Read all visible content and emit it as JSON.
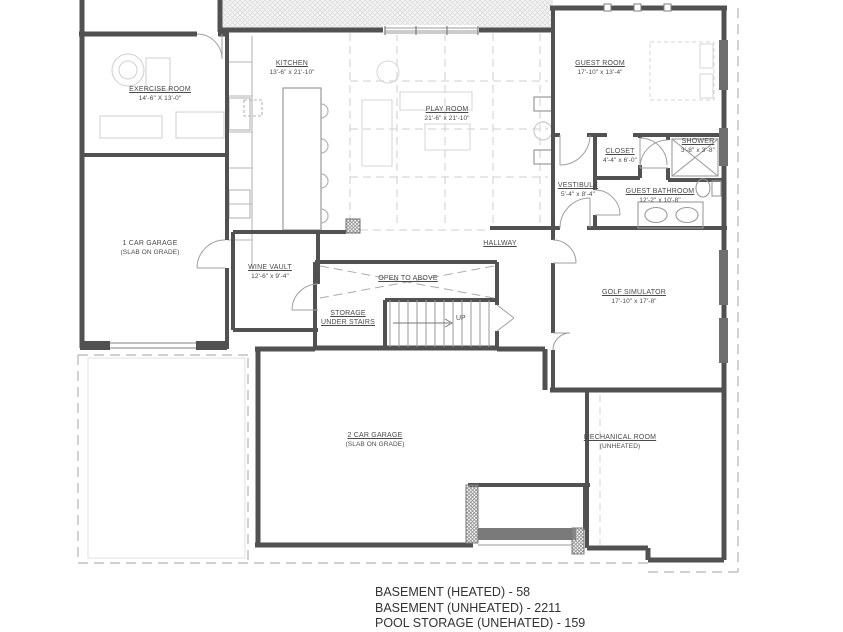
{
  "plan_title": "Basement Floor Plan",
  "rooms": [
    {
      "name": "EXERCISE ROOM",
      "dims": "14'-6\" X 13'-0\""
    },
    {
      "name": "KITCHEN",
      "dims": "13'-6\" x 21'-10\""
    },
    {
      "name": "PLAY ROOM",
      "dims": "21'-6\" x 21'-10\""
    },
    {
      "name": "GUEST ROOM",
      "dims": "17'-10\" x 13'-4\""
    },
    {
      "name": "CLOSET",
      "dims": "4'-4\" x 6'-0\""
    },
    {
      "name": "SHOWER",
      "dims": "3'-8\" x 3'-8\""
    },
    {
      "name": "VESTIBULE",
      "dims": "5'-4\" x 8'-4\""
    },
    {
      "name": "GUEST BATHROOM",
      "dims": "12'-2\" x 10'-8\""
    },
    {
      "name": "HALLWAY",
      "dims": ""
    },
    {
      "name": "1 CAR GARAGE",
      "dims": "(SLAB ON GRADE)"
    },
    {
      "name": "WINE VAULT",
      "dims": "12'-6\" x 9'-4\""
    },
    {
      "name": "OPEN TO ABOVE",
      "dims": ""
    },
    {
      "name": "STORAGE UNDER STAIRS",
      "dims": ""
    },
    {
      "name": "GOLF SIMULATOR",
      "dims": "17'-10\" x 17'-8\""
    },
    {
      "name": "2 CAR GARAGE",
      "dims": "(SLAB ON GRADE)"
    },
    {
      "name": "MECHANICAL ROOM",
      "dims": "(UNHEATED)"
    },
    {
      "name": "",
      "dims": "13'-4\" x 9'-4\""
    }
  ],
  "stairs": {
    "up_label": "UP"
  },
  "summary": {
    "line1": "BASEMENT (HEATED) - 58",
    "line2": "BASEMENT (UNHEATED) - 2211",
    "line3": "POOL STORAGE (UNEHATED) - 159"
  },
  "colors": {
    "wall": "#515151",
    "window_panel": "#6e6e6e",
    "light_line": "#b5b5b5",
    "dashed_property": "#b3b3b3",
    "label_text": "#4a4a4a",
    "summary_text": "#333333"
  }
}
